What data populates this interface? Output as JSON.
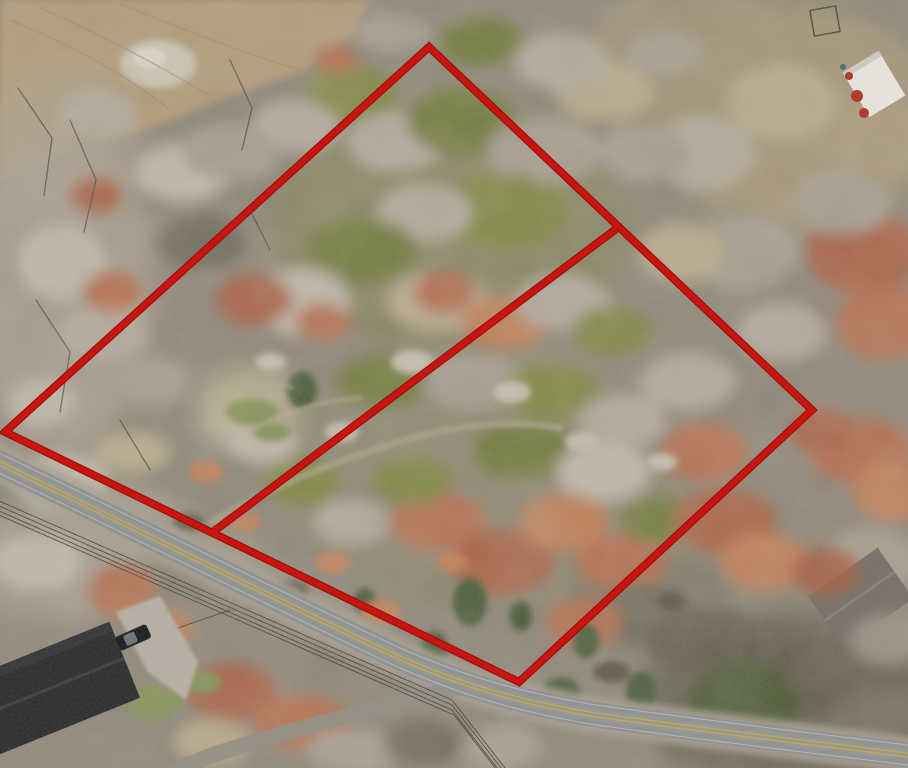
{
  "photo": {
    "subject": "aerial-drone-view-two-wooded-lots-outlined-in-red",
    "canvas": {
      "width": 908,
      "height": 768
    }
  },
  "boundary_overlay": {
    "color": "#c8150f",
    "edge_color": "#9c0f0b",
    "parcel_outline_points": "429,47 812,410 519,682 5,432",
    "lot_divider_d": "M 616,229 L 213,532"
  },
  "road": {
    "main_d": "M -12,458 C 120,520 280,602 400,658 C 460,684 510,700 590,714 C 700,730 820,744 916,756",
    "branch_d": "M 458,688 C 390,704 300,728 228,750 C 205,757 190,764 172,772",
    "asphalt_color": "#8e9092",
    "shoulder_color": "#a8a193",
    "centerline_color": "#c9a93d",
    "edge_line_color": "#d4d5d2"
  },
  "terrain": {
    "base_color": "#8d8476",
    "dirt_area_color": "#b19a75",
    "dirt_area_points": "0,0 370,0 352,38 300,72 232,96 150,128 70,152 0,180",
    "rock_patch_color": "#cfc8b6",
    "canopy_palette": [
      "#a85f42",
      "#b46c4b",
      "#c07b53",
      "#6e7838",
      "#7d8540",
      "#3f5230",
      "#b2a89a",
      "#c0b7a9",
      "#a59b8d",
      "#ab9a78",
      "#b7a88a",
      "#5f594a",
      "#6e685a",
      "#7f8f4f"
    ]
  },
  "structures": {
    "house_sw_roof_color": "#2a2b2d",
    "house_se_roof_color": "#756f67",
    "shed_ne_roof_color": "#eae7e1",
    "equipment_color": "#b23027",
    "car_color": "#17191d",
    "driveway_color": "#b6b1a4",
    "driveway_points": "116,612 160,596 198,662 186,700 148,672"
  },
  "powerlines": {
    "color": "#35342c",
    "main_d": "M -10,497 L 452,700 L 505,768",
    "service_drop_d": "M 230,610 L 120,648"
  }
}
